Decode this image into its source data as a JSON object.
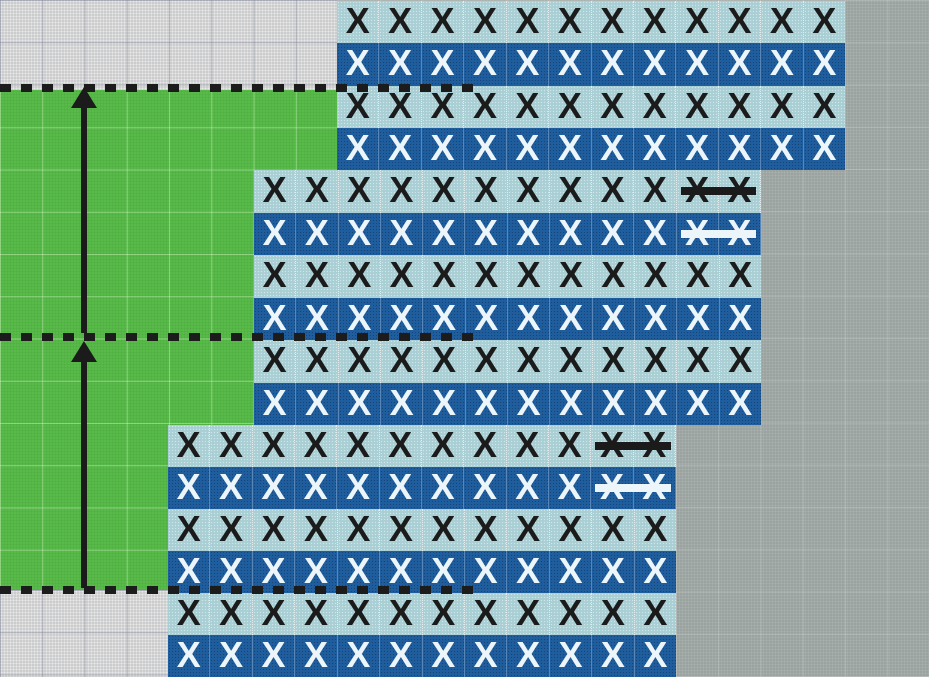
{
  "diagram": {
    "type": "colorwork-stitch-chart",
    "mark_glyph": "X",
    "colors": {
      "background_right": "#9ba3a1",
      "background_left": "#cbcccd",
      "green_area": "#58ba49",
      "cell_light": "#a9cfd4",
      "cell_dark": "#1f5e9e",
      "mark_on_light": "#1b1b1b",
      "mark_on_dark": "#ecf5f9",
      "dotted_line": "#1c1c1c",
      "arrow": "#1b1b1b"
    },
    "blocks": [
      {
        "id": "stitch-block-1",
        "columns": 12,
        "frame": {
          "left": 337,
          "top": 1,
          "width": 508,
          "height": 169
        },
        "rows": [
          {
            "shade": "light",
            "marks": 12,
            "struck_columns": []
          },
          {
            "shade": "dark",
            "marks": 12,
            "struck_columns": []
          },
          {
            "shade": "light",
            "marks": 12,
            "struck_columns": []
          },
          {
            "shade": "dark",
            "marks": 12,
            "struck_columns": []
          }
        ]
      },
      {
        "id": "stitch-block-2",
        "columns": 12,
        "frame": {
          "left": 254,
          "top": 170,
          "width": 507,
          "height": 255
        },
        "rows": [
          {
            "shade": "light",
            "marks": 12,
            "struck_columns": [
              11,
              12
            ]
          },
          {
            "shade": "dark",
            "marks": 12,
            "struck_columns": [
              11,
              12
            ]
          },
          {
            "shade": "light",
            "marks": 12,
            "struck_columns": []
          },
          {
            "shade": "dark",
            "marks": 12,
            "struck_columns": []
          },
          {
            "shade": "light",
            "marks": 12,
            "struck_columns": []
          },
          {
            "shade": "dark",
            "marks": 12,
            "struck_columns": []
          }
        ]
      },
      {
        "id": "stitch-block-3",
        "columns": 12,
        "frame": {
          "left": 168,
          "top": 425,
          "width": 508,
          "height": 252
        },
        "rows": [
          {
            "shade": "light",
            "marks": 12,
            "struck_columns": [
              11,
              12
            ]
          },
          {
            "shade": "dark",
            "marks": 12,
            "struck_columns": [
              11,
              12
            ]
          },
          {
            "shade": "light",
            "marks": 12,
            "struck_columns": []
          },
          {
            "shade": "dark",
            "marks": 12,
            "struck_columns": []
          },
          {
            "shade": "light",
            "marks": 12,
            "struck_columns": []
          },
          {
            "shade": "dark",
            "marks": 12,
            "struck_columns": []
          }
        ]
      }
    ],
    "green_region_steps": [
      {
        "x_right": 337,
        "y_from": 90,
        "y_to": 170
      },
      {
        "x_right": 254,
        "y_from": 170,
        "y_to": 425
      },
      {
        "x_right": 168,
        "y_from": 425,
        "y_to": 590
      }
    ],
    "repeat_boundary_lines": [
      {
        "y": 84,
        "x_start": 0,
        "x_end": 478
      },
      {
        "y": 333,
        "x_start": 0,
        "x_end": 478
      },
      {
        "y": 586,
        "x_start": 0,
        "x_end": 478
      }
    ],
    "repeat_arrows": [
      {
        "x_center": 84,
        "tip_y": 87,
        "tail_y": 333,
        "direction": "up"
      },
      {
        "x_center": 84,
        "tip_y": 341,
        "tail_y": 588,
        "direction": "up"
      }
    ]
  }
}
